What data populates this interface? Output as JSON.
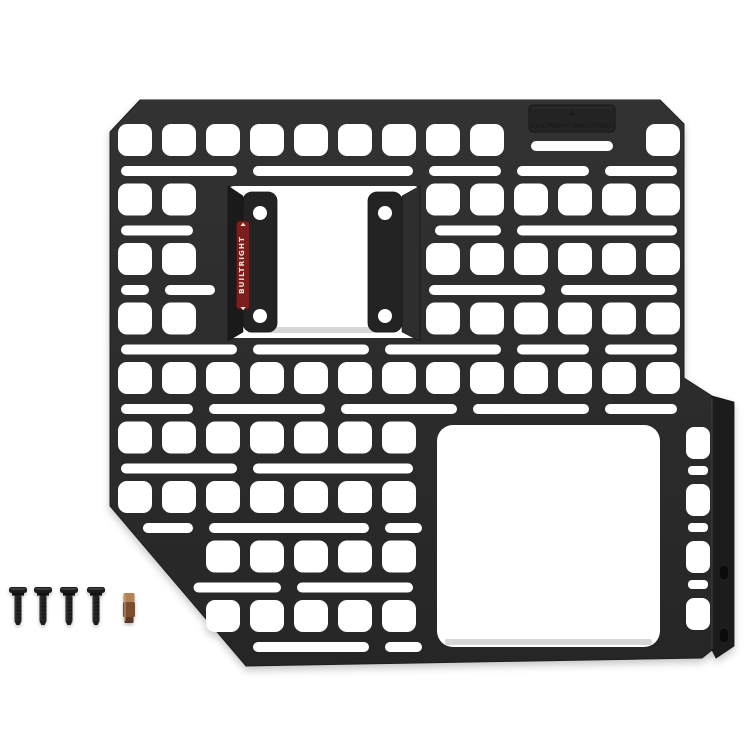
{
  "scene": {
    "description": "Product photo of a black modular MOLLE storage panel with two mounting brackets, a side mounting flange, four black screws and one bronze driver bit on a white background",
    "background": "#ffffff"
  },
  "panel": {
    "body_color": "#262626",
    "body_color_light": "#323232",
    "edge_color": "#1e1e1e",
    "hole_color": "#ffffff",
    "outline": "M 140,100 L 660,100 L 684,124 L 684,378 L 712,396 L 712,650 L 702,658 L 246,666 L 110,506 L 110,132 Z",
    "grid": {
      "col_start": 118,
      "col_pitch": 44,
      "cols": 13,
      "hole_w": 34,
      "hole_h": 32,
      "hole_r": 9,
      "row_start": 124,
      "row_pitch": 59.5,
      "rows": 9,
      "slot_offset": 42,
      "slot_h": 10,
      "slot_r": 5,
      "max_x": 681,
      "diagonal": {
        "x1": 110,
        "y1": 506,
        "x2": 246,
        "y2": 666
      },
      "blocked": [
        [
          520,
          96,
          104,
          40
        ],
        [
          224,
          180,
          202,
          162
        ],
        [
          431,
          419,
          229,
          228
        ]
      ],
      "skip_squares": [
        [
          1,
          7
        ]
      ],
      "slot_rows": [
        [
          [
            0,
            2
          ],
          [
            3,
            6
          ],
          [
            7,
            8
          ],
          [
            9,
            10
          ],
          [
            11,
            12
          ]
        ],
        [
          [
            0,
            1
          ],
          [
            2,
            4
          ],
          [
            5,
            8
          ],
          [
            9,
            12
          ]
        ],
        [
          [
            0,
            0
          ],
          [
            1,
            2
          ],
          [
            3,
            6
          ],
          [
            7,
            9
          ],
          [
            10,
            12
          ]
        ],
        [
          [
            0,
            2
          ],
          [
            3,
            5
          ],
          [
            6,
            8
          ],
          [
            9,
            10
          ],
          [
            11,
            12
          ]
        ],
        [
          [
            0,
            1
          ],
          [
            2,
            4
          ],
          [
            5,
            7
          ],
          [
            8,
            10
          ],
          [
            11,
            12
          ]
        ],
        [
          [
            0,
            2
          ],
          [
            3,
            6
          ],
          [
            7,
            9
          ],
          [
            10,
            12
          ]
        ],
        [
          [
            0,
            1
          ],
          [
            2,
            5
          ],
          [
            6,
            8
          ],
          [
            9,
            11
          ],
          [
            12,
            12
          ]
        ],
        [
          [
            0,
            3
          ],
          [
            4,
            6
          ],
          [
            7,
            9
          ],
          [
            10,
            12
          ]
        ],
        [
          [
            0,
            2
          ],
          [
            3,
            5
          ],
          [
            6,
            8
          ],
          [
            9,
            12
          ]
        ]
      ]
    },
    "right_column": {
      "squares": [
        [
          686,
          427
        ],
        [
          686,
          484
        ],
        [
          686,
          541
        ],
        [
          686,
          598
        ]
      ],
      "square_w": 24,
      "square_h": 32,
      "slots": [
        [
          688,
          466
        ],
        [
          688,
          523
        ],
        [
          688,
          580
        ]
      ],
      "slot_w": 20,
      "slot_h": 9
    },
    "extra_slots": [
      [
        531,
        141,
        82,
        10
      ]
    ],
    "center_cutout": {
      "x": 228,
      "y": 186,
      "w": 192,
      "h": 152,
      "r": 6,
      "edge_strip": [
        248,
        327,
        148,
        6
      ]
    },
    "big_cutout": {
      "x": 437,
      "y": 425,
      "w": 223,
      "h": 222,
      "r": 16,
      "edge_strip": [
        445,
        639,
        207,
        6
      ]
    },
    "edge_strip_color": "#d6d6d6",
    "badge": {
      "x": 529,
      "y": 105,
      "w": 86,
      "h": 27,
      "r": 4,
      "color": "#232323",
      "border": "#181818",
      "text": "BUILTRIGHT INDUSTRIES",
      "text_color": "#151515"
    },
    "brackets": {
      "color": "#232323",
      "hole_r": 7,
      "left": {
        "flat": [
          243,
          192,
          34,
          140
        ],
        "slant": "228,186 243,196 243,332 228,341",
        "slant_color": "#1a1a1a",
        "holes": [
          [
            260,
            213
          ],
          [
            260,
            316
          ]
        ]
      },
      "right": {
        "flat": [
          368,
          192,
          34,
          140
        ],
        "slant": "420,186 402,196 402,332 420,341",
        "slant_color": "#2e2e2e",
        "holes": [
          [
            385,
            213
          ],
          [
            385,
            316
          ]
        ]
      }
    },
    "label": {
      "x": 236.5,
      "y": 221,
      "w": 13,
      "h": 88,
      "r": 3,
      "bg": "#7d1e1e",
      "border": "#4a0f0f",
      "fg": "#f2e6dc",
      "text": "BUILTRIGHT"
    },
    "flange": {
      "color": "#1c1c1c",
      "points": "712,396 734,402 734,646 716,658 712,650",
      "fold_highlight": "#454545",
      "hole_color": "#0b0b0b",
      "holes": [
        [
          720,
          566
        ],
        [
          720,
          629
        ]
      ],
      "hole_w": 8,
      "hole_h": 13
    }
  },
  "hardware": {
    "screws": {
      "count": 4,
      "x": [
        18,
        43,
        69,
        96
      ],
      "head_y": 587,
      "head_w": 18,
      "shaft_w": 7,
      "length": 38,
      "color": "#1a1a1a",
      "shaft_color": "#232323",
      "highlight": "#4a4a4a"
    },
    "bit": {
      "count": 1,
      "x": 129,
      "y": 593,
      "shank_color": "#b08456",
      "body_color": "#7c4e31",
      "tip_color": "#5b3822"
    }
  }
}
